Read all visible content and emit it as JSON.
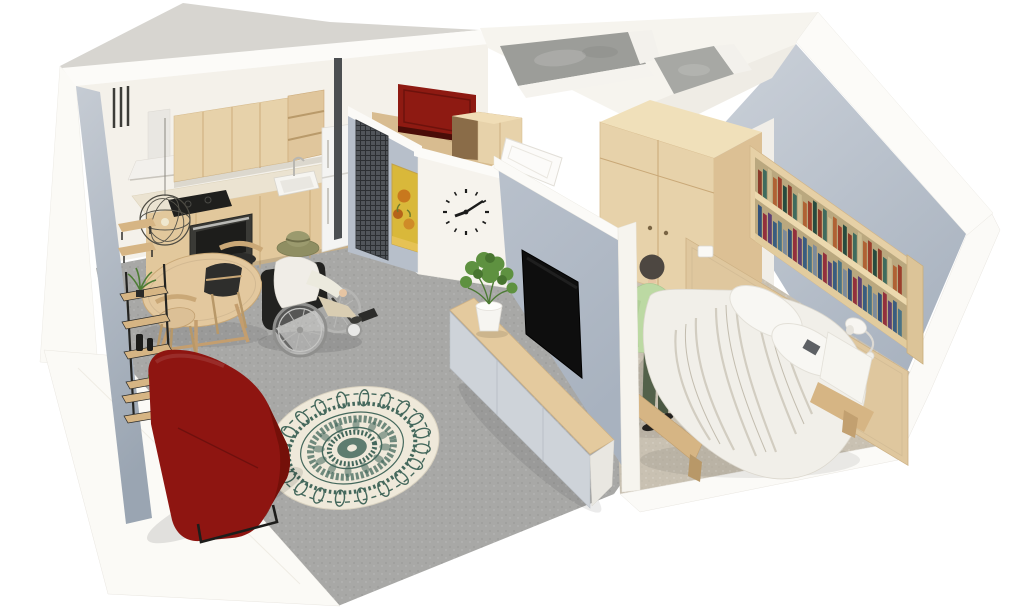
{
  "meta": {
    "type": "3d-floor-plan-rendering",
    "view": "isometric dollhouse cutaway",
    "description": "3D isometric cutaway rendering of a small apartment: open kitchen and living room with a person in a wheelchair, a dark red sofa, a round mandala rug and a round dining table; an entry hall with a dark red front door, wall clock, sunflower painting and mesh screen; an unfinished concrete bathroom; and a bedroom with a double bed, wardrobe, wall bookshelf, TV wall with sideboard and a standing person."
  },
  "colors": {
    "background": "#ffffff",
    "wall_white": "#f4f1ea",
    "wall_top": "#fbfaf7",
    "wall_shadow": "#d7d5d0",
    "accent_wall": "#b7bfca",
    "floor_gray": "#a8a8a6",
    "floor_wood": "#d8bc90",
    "carpet": "#c9c1b2",
    "concrete": "#9c9d99",
    "wood_light": "#e7d2aa",
    "wood_mid": "#d6b584",
    "wood_dark": "#c2a070",
    "counter": "#ebe3d1",
    "appliance": "#f4f4f2",
    "sofa_red": "#8e1511",
    "door_red": "#8e1a12",
    "rug_cream": "#efe9da",
    "rug_teal": "#44685c",
    "tv_black": "#0e0e0e",
    "plant_green": "#5e9140",
    "shirt_white": "#f0ede7",
    "hat_olive": "#8f8e62",
    "cardigan_green": "#bcd9a3",
    "pants_green": "#53614a",
    "skin": "#e6c5a3",
    "hair": "#4d4741",
    "metal_dark": "#2e2e2c",
    "books": [
      "#8a3b2a",
      "#31517a",
      "#b98a3c",
      "#3f6b5e",
      "#93303d",
      "#5d80a6",
      "#cdbd92",
      "#5c3f74",
      "#2f5f4c",
      "#b06234",
      "#3a5d80",
      "#857248",
      "#9c3f2c",
      "#4a7386",
      "#a5925c",
      "#274b3f",
      "#7c8a9a",
      "#c2a04a"
    ]
  },
  "scene": {
    "rooms": [
      {
        "name": "living room with open kitchen",
        "floor": "grey",
        "objects": [
          "wood wall cabinets",
          "open shelves",
          "white range hood",
          "cooktop",
          "built-in oven",
          "sink with faucet",
          "refrigerator",
          "wire pendant lamp",
          "round dining table",
          "three chairs",
          "black wall shelf with plants and vases",
          "dark red sofa",
          "round mandala rug",
          "person in wheelchair wearing sun hat"
        ]
      },
      {
        "name": "entry hall",
        "floor": "wood",
        "objects": [
          "dark red front door",
          "built-in closet",
          "black mesh screen",
          "sunflower painting",
          "minimal wall clock",
          "white interior door"
        ]
      },
      {
        "name": "bathroom",
        "floor": "unseen",
        "objects": [
          "bare concrete walls (unfinished)"
        ]
      },
      {
        "name": "bedroom",
        "floor": "beige carpet",
        "objects": [
          "two-door wardrobe",
          "wall bookshelf full of books",
          "double bed with white bedding",
          "two pillows",
          "wooden headboard panel",
          "two white wall lamps",
          "standing person in green outfit",
          "TV wall with flat screen",
          "low sideboard with potted plant"
        ]
      }
    ],
    "clock": {
      "approx_time": "8:12"
    }
  }
}
